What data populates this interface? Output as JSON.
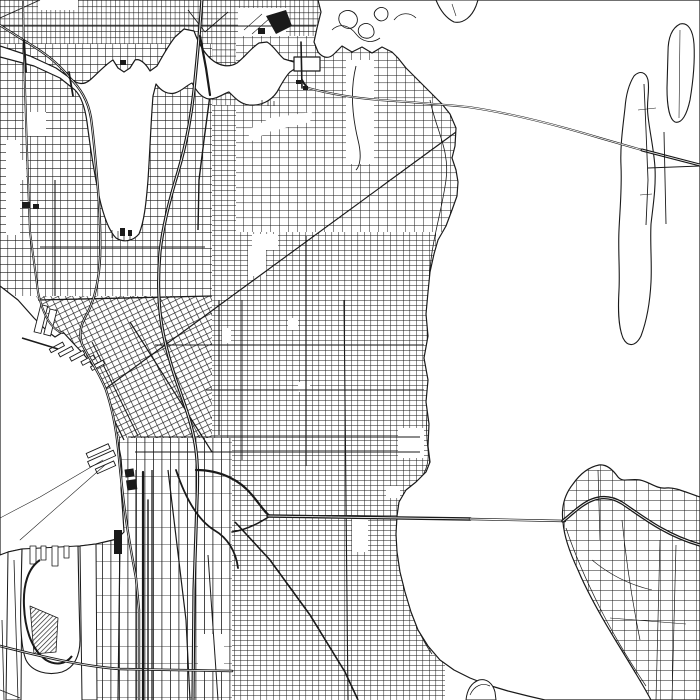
{
  "meta": {
    "description": "Minimalist black-and-white line-art street map of Seattle: Lake Union and the ship canal at top, Elliott Bay and Harbor Island lower left, Lake Washington on the right with the SR-520 and I-90 floating bridges, Medina peninsula top right and Mercer Island bottom right.",
    "style": "monochrome line-art map poster",
    "colors": {
      "background": "#ffffff",
      "ink": "#1a1a1a",
      "water": "#ffffff"
    }
  },
  "map": {
    "water_features": [
      "elliott-bay",
      "lake-union",
      "ship-canal",
      "portage-bay",
      "montlake-cut",
      "union-bay",
      "lake-washington",
      "east-waterway",
      "west-waterway"
    ],
    "islands_peninsulas": [
      "harbor-island",
      "mercer-island",
      "medina-evergreen-point",
      "hunts-point",
      "foster-island",
      "laurelhurst-point",
      "seward-park-tip"
    ],
    "street_grids": [
      "ballard-fremont-wallingford-fine-grid",
      "queen-anne-grid",
      "capitol-hill-dense-grid",
      "montlake-madison-grid",
      "downtown-rotated-grid",
      "sodo-vertical-grid",
      "rainier-valley-grid",
      "island-sparse-grids"
    ],
    "highways": [
      "i5-freeway",
      "sr99-aurora",
      "i90-freeway",
      "sr520-freeway",
      "west-seattle-bridge",
      "elliott-15th-ave"
    ],
    "bridges": [
      "sr520-floating-bridge",
      "i90-floating-bridge",
      "university-bridge",
      "fremont-bridge",
      "ballard-bridge",
      "montlake-bridge"
    ],
    "landmarks": [
      "stadium-blocks",
      "uw-stadium-block",
      "railyard-hatch",
      "waterfront-piers",
      "ferry-routes",
      "gas-works-point"
    ]
  },
  "aria_label": "Black and white street map of Seattle with lakes, bays, bridges and street grids"
}
